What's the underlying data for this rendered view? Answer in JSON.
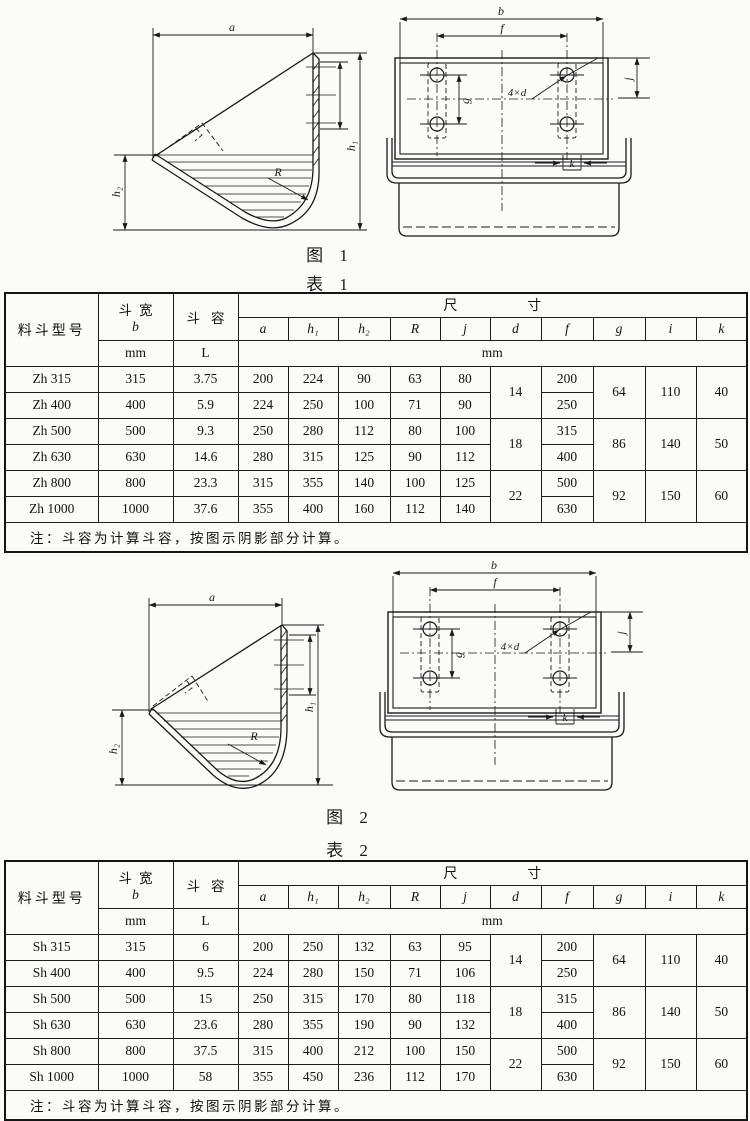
{
  "figure1": {
    "caption_fig": "图 1",
    "caption_table": "表 1",
    "side_labels": {
      "a": "a",
      "h1": "h₁",
      "h2": "h₂",
      "R": "R"
    },
    "rear_labels": {
      "b": "b",
      "f": "f",
      "g": "g",
      "j": "j",
      "k": "k",
      "d": "4×d"
    }
  },
  "table1": {
    "header": {
      "model": "料斗型号",
      "width_label": "斗宽",
      "width_sym": "b",
      "width_unit": "mm",
      "cap_label": "斗容",
      "cap_unit": "L",
      "dims_label": "尺寸",
      "dims_unit": "mm",
      "cols": [
        "a",
        "h₁",
        "h₂",
        "R",
        "j",
        "d",
        "f",
        "g",
        "i",
        "k"
      ]
    },
    "rows": [
      {
        "model": "Zh 315",
        "b": "315",
        "cap": "3.75",
        "a": "200",
        "h1": "224",
        "h2": "90",
        "R": "63",
        "j": "80",
        "f": "200"
      },
      {
        "model": "Zh 400",
        "b": "400",
        "cap": "5.9",
        "a": "224",
        "h1": "250",
        "h2": "100",
        "R": "71",
        "j": "90",
        "f": "250"
      },
      {
        "model": "Zh 500",
        "b": "500",
        "cap": "9.3",
        "a": "250",
        "h1": "280",
        "h2": "112",
        "R": "80",
        "j": "100",
        "f": "315"
      },
      {
        "model": "Zh 630",
        "b": "630",
        "cap": "14.6",
        "a": "280",
        "h1": "315",
        "h2": "125",
        "R": "90",
        "j": "112",
        "f": "400"
      },
      {
        "model": "Zh 800",
        "b": "800",
        "cap": "23.3",
        "a": "315",
        "h1": "355",
        "h2": "140",
        "R": "100",
        "j": "125",
        "f": "500"
      },
      {
        "model": "Zh 1000",
        "b": "1000",
        "cap": "37.6",
        "a": "355",
        "h1": "400",
        "h2": "160",
        "R": "112",
        "j": "140",
        "f": "630"
      }
    ],
    "merged": {
      "d": [
        "14",
        "18",
        "22"
      ],
      "g": [
        "64",
        "86",
        "92"
      ],
      "i": [
        "110",
        "140",
        "150"
      ],
      "k": [
        "40",
        "50",
        "60"
      ]
    },
    "note": "注：斗容为计算斗容，按图示阴影部分计算。"
  },
  "figure2": {
    "caption_fig": "图 2",
    "caption_table": "表 2",
    "side_labels": {
      "a": "a",
      "h1": "h₁",
      "h2": "h₂",
      "R": "R"
    },
    "rear_labels": {
      "b": "b",
      "f": "f",
      "g": "g",
      "j": "j",
      "k": "k",
      "d": "4×d"
    }
  },
  "table2": {
    "header": {
      "model": "料斗型号",
      "width_label": "斗宽",
      "width_sym": "b",
      "width_unit": "mm",
      "cap_label": "斗容",
      "cap_unit": "L",
      "dims_label": "尺寸",
      "dims_unit": "mm",
      "cols": [
        "a",
        "h₁",
        "h₂",
        "R",
        "j",
        "d",
        "f",
        "g",
        "i",
        "k"
      ]
    },
    "rows": [
      {
        "model": "Sh 315",
        "b": "315",
        "cap": "6",
        "a": "200",
        "h1": "250",
        "h2": "132",
        "R": "63",
        "j": "95",
        "f": "200"
      },
      {
        "model": "Sh 400",
        "b": "400",
        "cap": "9.5",
        "a": "224",
        "h1": "280",
        "h2": "150",
        "R": "71",
        "j": "106",
        "f": "250"
      },
      {
        "model": "Sh 500",
        "b": "500",
        "cap": "15",
        "a": "250",
        "h1": "315",
        "h2": "170",
        "R": "80",
        "j": "118",
        "f": "315"
      },
      {
        "model": "Sh 630",
        "b": "630",
        "cap": "23.6",
        "a": "280",
        "h1": "355",
        "h2": "190",
        "R": "90",
        "j": "132",
        "f": "400"
      },
      {
        "model": "Sh 800",
        "b": "800",
        "cap": "37.5",
        "a": "315",
        "h1": "400",
        "h2": "212",
        "R": "100",
        "j": "150",
        "f": "500"
      },
      {
        "model": "Sh 1000",
        "b": "1000",
        "cap": "58",
        "a": "355",
        "h1": "450",
        "h2": "236",
        "R": "112",
        "j": "170",
        "f": "630"
      }
    ],
    "merged": {
      "d": [
        "14",
        "18",
        "22"
      ],
      "g": [
        "64",
        "86",
        "92"
      ],
      "i": [
        "110",
        "140",
        "150"
      ],
      "k": [
        "40",
        "50",
        "60"
      ]
    },
    "note": "注：斗容为计算斗容，按图示阴影部分计算。"
  }
}
